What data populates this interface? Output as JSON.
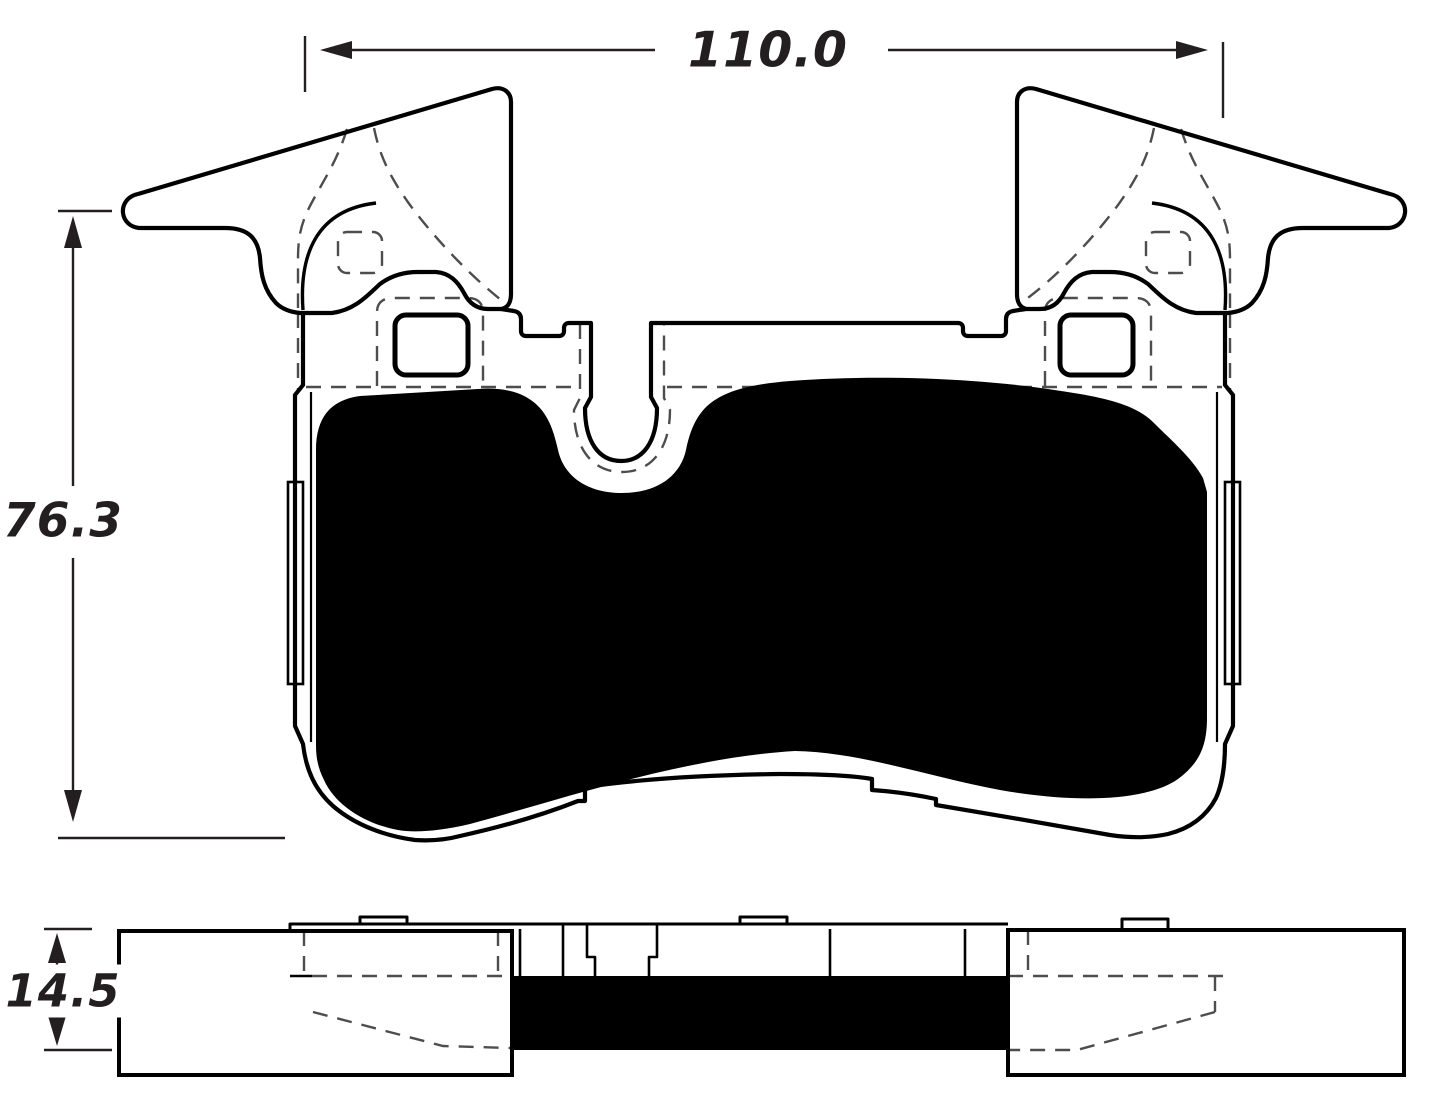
{
  "page": {
    "background": "#ffffff"
  },
  "drawing": {
    "kind": "technical-drawing",
    "subject": "brake-pad",
    "views": [
      {
        "id": "front-view",
        "description": "front elevation with friction material shown solid black, hidden clip lines dashed"
      },
      {
        "id": "side-view",
        "description": "bottom profile view with friction material shown solid black"
      }
    ],
    "colors": {
      "line": "#000000",
      "hidden_line": "#4d4d4f",
      "fill": "#000000",
      "text": "#231f20",
      "background": "#ffffff"
    }
  },
  "dimensions": {
    "width_mm": "110.0",
    "height_mm": "76.3",
    "thickness_mm": "14.5"
  }
}
